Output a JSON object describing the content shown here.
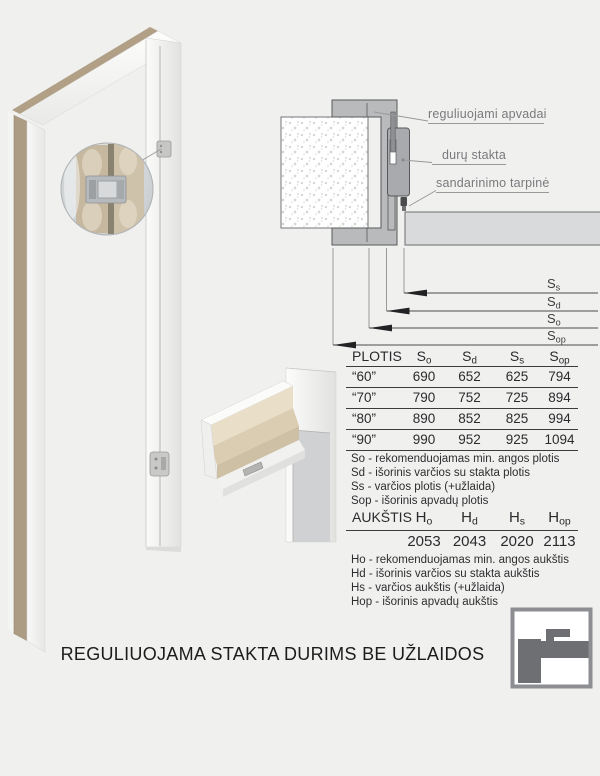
{
  "caption": "REGULIUOJAMA STAKTA DURIMS BE UŽLAIDOS",
  "colors": {
    "background": "#f0f0ef",
    "frame_gray": "#b9babc",
    "profile_gray": "#a9aaad",
    "door_leaf_gray": "#d9dadb",
    "label_gray": "#797a7d",
    "wood_tan": "#ac9c84"
  },
  "callouts": {
    "apvadai": "reguliuojami apvadai",
    "stakta": "durų stakta",
    "tarpine": "sandarinimo tarpinė"
  },
  "dims": [
    {
      "base": "S",
      "sub": "s"
    },
    {
      "base": "S",
      "sub": "d"
    },
    {
      "base": "S",
      "sub": "o"
    },
    {
      "base": "S",
      "sub": "op"
    }
  ],
  "width_table": {
    "title": "PLOTIS",
    "columns": [
      {
        "base": "S",
        "sub": "o"
      },
      {
        "base": "S",
        "sub": "d"
      },
      {
        "base": "S",
        "sub": "s"
      },
      {
        "base": "S",
        "sub": "op"
      }
    ],
    "rows": [
      {
        "label": "“60”",
        "c1": "690",
        "c2": "652",
        "c3": "625",
        "c4": "794"
      },
      {
        "label": "“70”",
        "c1": "790",
        "c2": "752",
        "c3": "725",
        "c4": "894"
      },
      {
        "label": "“80”",
        "c1": "890",
        "c2": "852",
        "c3": "825",
        "c4": "994"
      },
      {
        "label": "“90”",
        "c1": "990",
        "c2": "952",
        "c3": "925",
        "c4": "1094"
      }
    ]
  },
  "width_legend": [
    "So - rekomenduojamas min. angos plotis",
    "Sd - išorinis varčios su stakta plotis",
    "Ss - varčios plotis (+užlaida)",
    "Sop - išorinis apvadų plotis"
  ],
  "height_table": {
    "title": "AUKŠTIS",
    "columns": [
      {
        "base": "H",
        "sub": "o"
      },
      {
        "base": "H",
        "sub": "d"
      },
      {
        "base": "H",
        "sub": "s"
      },
      {
        "base": "H",
        "sub": "op"
      }
    ],
    "values": [
      "2053",
      "2043",
      "2020",
      "2113"
    ]
  },
  "height_legend": [
    "Ho - rekomenduojamas min. angos aukštis",
    "Hd - išorinis varčios su stakta aukštis",
    "Hs - varčios aukštis (+užlaida)",
    "Hop - išorinis apvadų aukštis"
  ]
}
